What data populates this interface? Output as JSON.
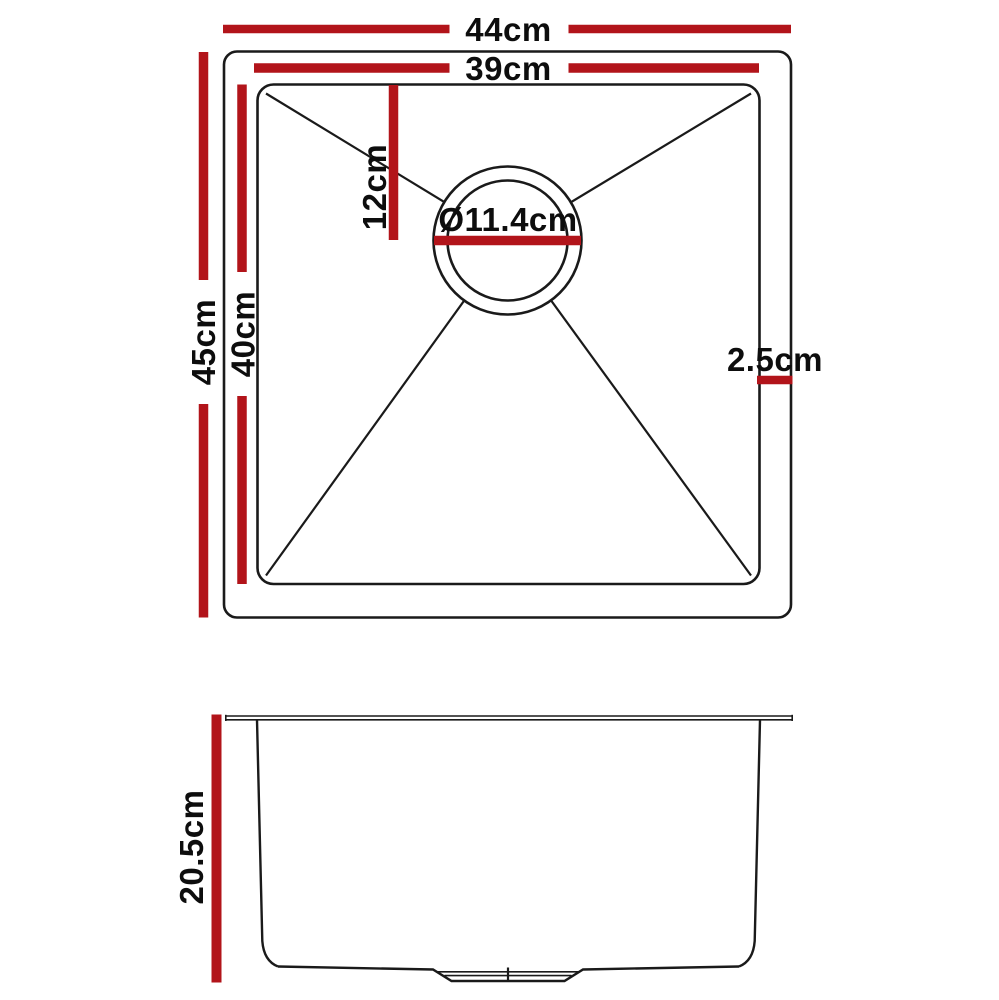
{
  "colors": {
    "dim_red": "#b2141a",
    "line_black": "#1a1a1a",
    "text_black": "#0d0d0d",
    "background": "#ffffff"
  },
  "top_view": {
    "dimensions": {
      "outer_width": "44cm",
      "inner_width": "39cm",
      "outer_depth": "45cm",
      "inner_depth": "40cm",
      "drain_offset": "12cm",
      "drain_diameter": "Ø11.4cm",
      "rim_width": "2.5cm"
    }
  },
  "side_view": {
    "dimensions": {
      "bowl_depth": "20.5cm"
    }
  }
}
